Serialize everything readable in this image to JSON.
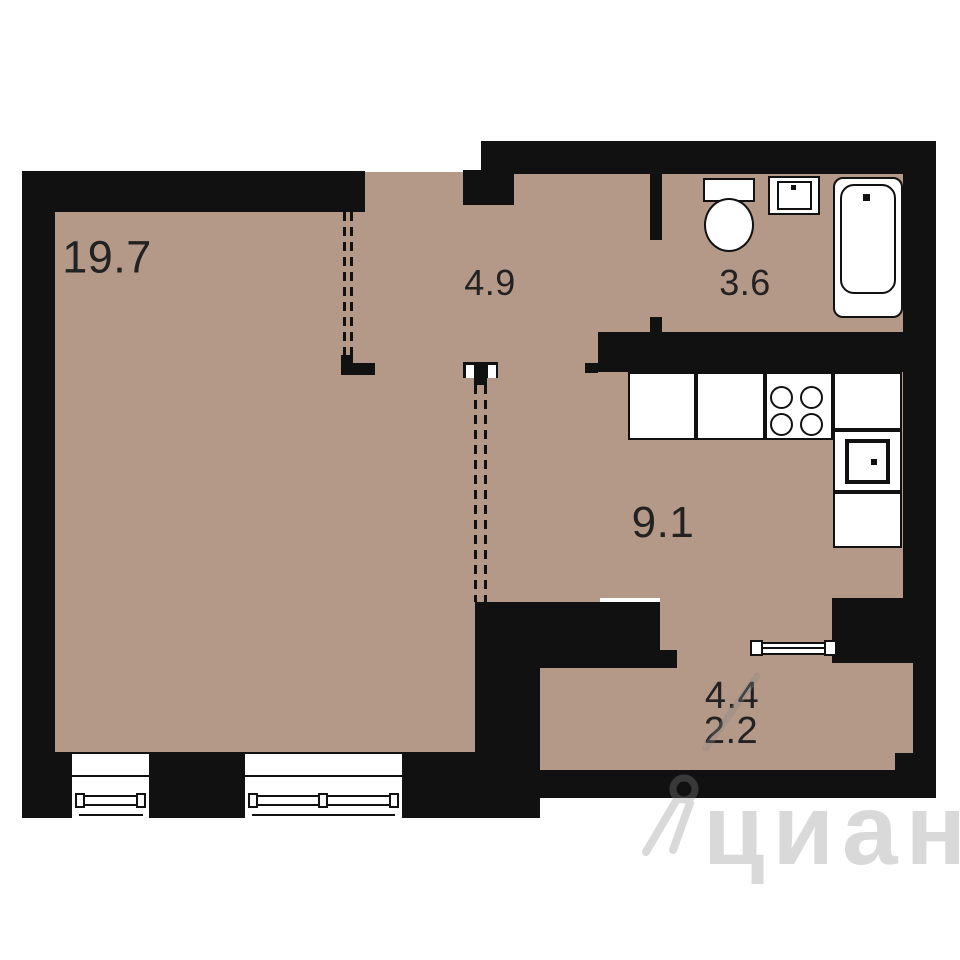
{
  "plan": {
    "rooms": [
      {
        "id": "living",
        "area": "19.7"
      },
      {
        "id": "hallway",
        "area": "4.9"
      },
      {
        "id": "bathroom",
        "area": "3.6"
      },
      {
        "id": "kitchen",
        "area": "9.1"
      },
      {
        "id": "balcony_full",
        "area": "4.4"
      },
      {
        "id": "balcony_reduced",
        "area": "2.2"
      }
    ],
    "fixtures": [
      "toilet",
      "washbasin",
      "bathtub",
      "stove",
      "kitchen-sink",
      "window",
      "wardrobe-partition"
    ]
  },
  "watermark": {
    "text": "циан"
  },
  "colors": {
    "floor": "#b49888",
    "wall": "#111111",
    "fixture_fill": "#ffffff",
    "label": "#222222",
    "watermark": "#8a8a8a"
  }
}
